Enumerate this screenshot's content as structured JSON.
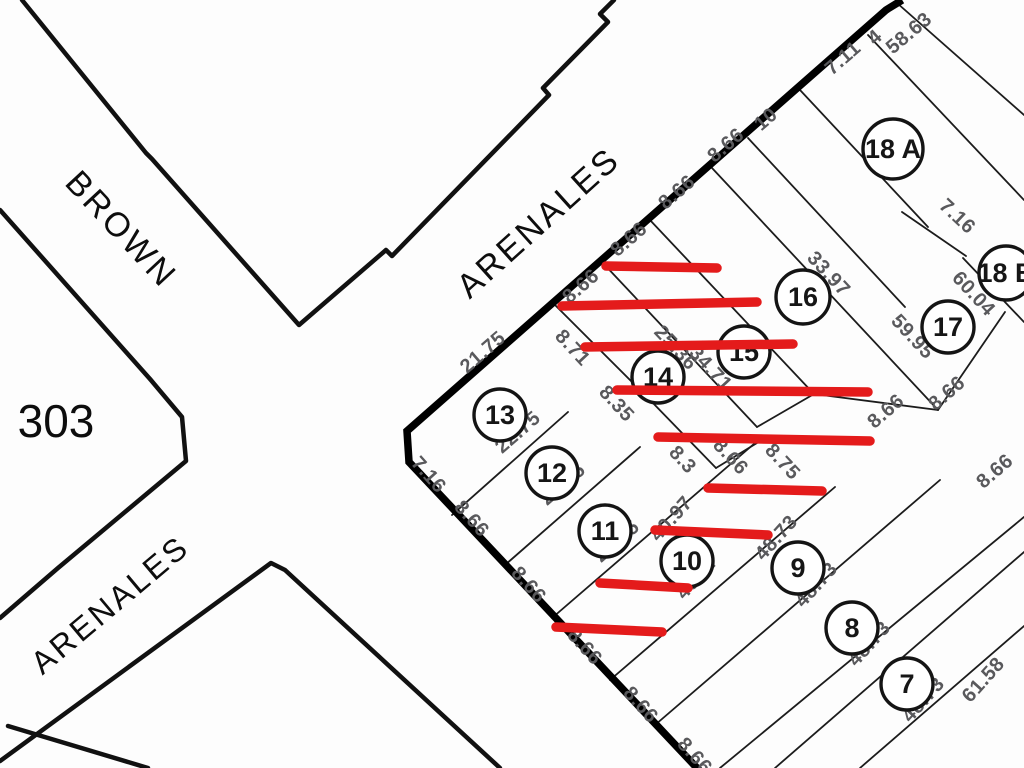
{
  "map_title": "Cadastral lot plan",
  "block": {
    "number": "303"
  },
  "streets": [
    {
      "name": "BROWN"
    },
    {
      "name": "ARENALES"
    },
    {
      "name": "ARENALES"
    }
  ],
  "colors": {
    "line_black": "#111111",
    "dimension_gray": "#59595c",
    "annotation_red": "#e41b1b",
    "paper": "#fdfdfd"
  },
  "lots": [
    {
      "label": "13",
      "x": 500,
      "y": 415,
      "r": 26
    },
    {
      "label": "12",
      "x": 552,
      "y": 473,
      "r": 26
    },
    {
      "label": "11",
      "x": 605,
      "y": 531,
      "r": 26
    },
    {
      "label": "10",
      "x": 687,
      "y": 561,
      "r": 26
    },
    {
      "label": "9",
      "x": 798,
      "y": 568,
      "r": 26
    },
    {
      "label": "8",
      "x": 852,
      "y": 628,
      "r": 26
    },
    {
      "label": "7",
      "x": 907,
      "y": 684,
      "r": 26
    },
    {
      "label": "14",
      "x": 658,
      "y": 377,
      "r": 26
    },
    {
      "label": "15",
      "x": 744,
      "y": 352,
      "r": 26
    },
    {
      "label": "16",
      "x": 803,
      "y": 297,
      "r": 27
    },
    {
      "label": "17",
      "x": 948,
      "y": 327,
      "r": 26
    },
    {
      "label": "18 A",
      "x": 893,
      "y": 149,
      "r": 30
    },
    {
      "label": "18 B",
      "x": 1006,
      "y": 273,
      "r": 27
    }
  ],
  "dimensions": [
    {
      "text": "21.75",
      "x": 487,
      "y": 357,
      "rot": -41
    },
    {
      "text": "8.66",
      "x": 585,
      "y": 291,
      "rot": -41
    },
    {
      "text": "8.66",
      "x": 633,
      "y": 244,
      "rot": -41
    },
    {
      "text": "8.66",
      "x": 681,
      "y": 197,
      "rot": -41
    },
    {
      "text": "8.66",
      "x": 730,
      "y": 150,
      "rot": -41
    },
    {
      "text": "10",
      "x": 770,
      "y": 124,
      "rot": -41
    },
    {
      "text": "7.11",
      "x": 847,
      "y": 63,
      "rot": -41
    },
    {
      "text": "4",
      "x": 879,
      "y": 42,
      "rot": -41,
      "size": 17
    },
    {
      "text": "58.63",
      "x": 913,
      "y": 38,
      "rot": -40
    },
    {
      "text": "7.16",
      "x": 424,
      "y": 479,
      "rot": 48
    },
    {
      "text": "8.66",
      "x": 467,
      "y": 523,
      "rot": 48
    },
    {
      "text": "8.66",
      "x": 524,
      "y": 589,
      "rot": 48
    },
    {
      "text": "8.66",
      "x": 580,
      "y": 651,
      "rot": 48
    },
    {
      "text": "8.66",
      "x": 636,
      "y": 709,
      "rot": 48
    },
    {
      "text": "8.66",
      "x": 690,
      "y": 760,
      "rot": 48
    },
    {
      "text": "22.75",
      "x": 522,
      "y": 437,
      "rot": -41
    },
    {
      "text": "22.75",
      "x": 567,
      "y": 489,
      "rot": -41
    },
    {
      "text": "22.75",
      "x": 621,
      "y": 546,
      "rot": -41
    },
    {
      "text": "40.97",
      "x": 676,
      "y": 523,
      "rot": -48
    },
    {
      "text": "40.07",
      "x": 702,
      "y": 581,
      "rot": -48
    },
    {
      "text": "48.73",
      "x": 781,
      "y": 542,
      "rot": -48
    },
    {
      "text": "48.73",
      "x": 821,
      "y": 589,
      "rot": -48
    },
    {
      "text": "48.73",
      "x": 874,
      "y": 648,
      "rot": -48
    },
    {
      "text": "48.73",
      "x": 928,
      "y": 704,
      "rot": -48
    },
    {
      "text": "61.58",
      "x": 988,
      "y": 684,
      "rot": -48
    },
    {
      "text": "8.71",
      "x": 568,
      "y": 352,
      "rot": 47
    },
    {
      "text": "8.35",
      "x": 612,
      "y": 408,
      "rot": 47
    },
    {
      "text": "25.36",
      "x": 671,
      "y": 352,
      "rot": 47
    },
    {
      "text": "34.71",
      "x": 706,
      "y": 373,
      "rot": 47
    },
    {
      "text": "8.3",
      "x": 678,
      "y": 464,
      "rot": 47
    },
    {
      "text": "8.66",
      "x": 726,
      "y": 461,
      "rot": 47
    },
    {
      "text": "8.75",
      "x": 778,
      "y": 466,
      "rot": 47
    },
    {
      "text": "33.97",
      "x": 824,
      "y": 278,
      "rot": 47
    },
    {
      "text": "59.95",
      "x": 908,
      "y": 341,
      "rot": 47
    },
    {
      "text": "60.04",
      "x": 969,
      "y": 298,
      "rot": 47
    },
    {
      "text": "7.16",
      "x": 953,
      "y": 221,
      "rot": 43
    },
    {
      "text": "8.66",
      "x": 890,
      "y": 416,
      "rot": -41
    },
    {
      "text": "8.66",
      "x": 951,
      "y": 398,
      "rot": -41
    },
    {
      "text": "8.66",
      "x": 999,
      "y": 476,
      "rot": -41
    }
  ],
  "red_lines": [
    [
      606,
      266,
      717,
      268
    ],
    [
      562,
      306,
      757,
      302
    ],
    [
      585,
      347,
      793,
      344
    ],
    [
      617,
      390,
      868,
      392
    ],
    [
      658,
      437,
      870,
      441
    ],
    [
      708,
      488,
      822,
      491
    ],
    [
      655,
      530,
      768,
      535
    ],
    [
      600,
      583,
      688,
      588
    ],
    [
      556,
      627,
      662,
      632
    ]
  ]
}
